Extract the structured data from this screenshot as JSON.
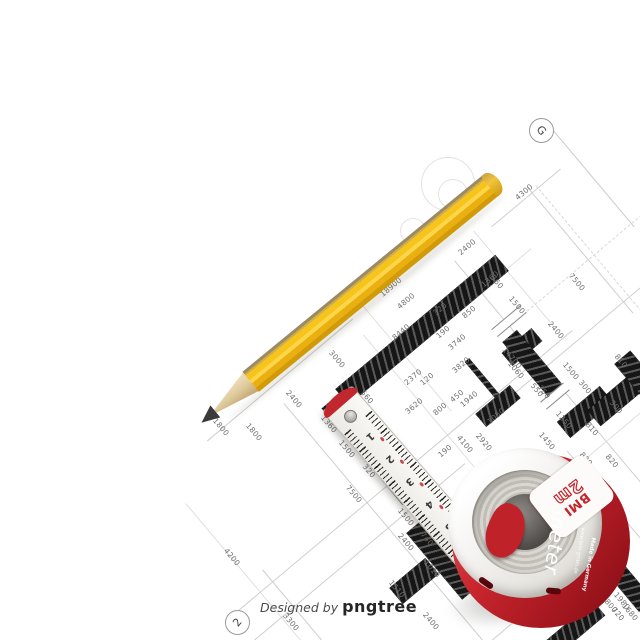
{
  "colors": {
    "paper": "#ffffff",
    "pencil_yellow": "#f6c41a",
    "tape_red": "#c1272d",
    "wall_black": "#161616",
    "dimension_text": "#6f6f6f"
  },
  "watermark": {
    "prefix": "Designed by ",
    "brand": "pngtree"
  },
  "blueprint": {
    "grid_markers": [
      {
        "label": "G"
      },
      {
        "label": "2"
      }
    ],
    "dimension_labels": [
      {
        "t": "4300",
        "x": 524,
        "y": 192,
        "r": "a"
      },
      {
        "t": "2400",
        "x": 467,
        "y": 247,
        "r": "a"
      },
      {
        "t": "1360",
        "x": 490,
        "y": 279,
        "r": "a"
      },
      {
        "t": "18900",
        "x": 391,
        "y": 287,
        "r": "a"
      },
      {
        "t": "4800",
        "x": 406,
        "y": 301,
        "r": "a"
      },
      {
        "t": "320",
        "x": 440,
        "y": 309,
        "r": "a"
      },
      {
        "t": "850",
        "x": 469,
        "y": 312,
        "r": "a"
      },
      {
        "t": "8440",
        "x": 401,
        "y": 332,
        "r": "a"
      },
      {
        "t": "190",
        "x": 443,
        "y": 332,
        "r": "a"
      },
      {
        "t": "3740",
        "x": 457,
        "y": 342,
        "r": "a"
      },
      {
        "t": "3820",
        "x": 461,
        "y": 365,
        "r": "a"
      },
      {
        "t": "2370",
        "x": 413,
        "y": 377,
        "r": "a"
      },
      {
        "t": "120",
        "x": 427,
        "y": 379,
        "r": "a"
      },
      {
        "t": "450",
        "x": 457,
        "y": 396,
        "r": "a"
      },
      {
        "t": "1940",
        "x": 469,
        "y": 399,
        "r": "a"
      },
      {
        "t": "3620",
        "x": 414,
        "y": 406,
        "r": "a"
      },
      {
        "t": "800",
        "x": 440,
        "y": 409,
        "r": "a"
      },
      {
        "t": "1050",
        "x": 496,
        "y": 416,
        "r": "a"
      },
      {
        "t": "190",
        "x": 445,
        "y": 451,
        "r": "a"
      },
      {
        "t": "360",
        "x": 497,
        "y": 282,
        "r": "b"
      },
      {
        "t": "7500",
        "x": 577,
        "y": 282,
        "r": "b"
      },
      {
        "t": "1500",
        "x": 517,
        "y": 305,
        "r": "b"
      },
      {
        "t": "2400",
        "x": 556,
        "y": 330,
        "r": "b"
      },
      {
        "t": "14700",
        "x": 512,
        "y": 358,
        "r": "b"
      },
      {
        "t": "3000",
        "x": 337,
        "y": 359,
        "r": "b"
      },
      {
        "t": "810",
        "x": 621,
        "y": 361,
        "r": "b"
      },
      {
        "t": "1060",
        "x": 516,
        "y": 370,
        "r": "b"
      },
      {
        "t": "1500",
        "x": 571,
        "y": 371,
        "r": "b"
      },
      {
        "t": "300",
        "x": 585,
        "y": 387,
        "r": "b"
      },
      {
        "t": "550",
        "x": 537,
        "y": 390,
        "r": "b"
      },
      {
        "t": "750",
        "x": 544,
        "y": 392,
        "r": "b"
      },
      {
        "t": "560",
        "x": 367,
        "y": 397,
        "r": "b"
      },
      {
        "t": "2400",
        "x": 294,
        "y": 399,
        "r": "b"
      },
      {
        "t": "300",
        "x": 616,
        "y": 407,
        "r": "b"
      },
      {
        "t": "1250",
        "x": 564,
        "y": 420,
        "r": "b"
      },
      {
        "t": "1360",
        "x": 329,
        "y": 424,
        "r": "b"
      },
      {
        "t": "1800",
        "x": 221,
        "y": 427,
        "r": "b"
      },
      {
        "t": "810",
        "x": 592,
        "y": 429,
        "r": "b"
      },
      {
        "t": "1800",
        "x": 254,
        "y": 432,
        "r": "b"
      },
      {
        "t": "1450",
        "x": 547,
        "y": 441,
        "r": "b"
      },
      {
        "t": "4100",
        "x": 465,
        "y": 444,
        "r": "b"
      },
      {
        "t": "2920",
        "x": 484,
        "y": 442,
        "r": "b"
      },
      {
        "t": "1500",
        "x": 347,
        "y": 449,
        "r": "b"
      },
      {
        "t": "820",
        "x": 586,
        "y": 459,
        "r": "b"
      },
      {
        "t": "820",
        "x": 612,
        "y": 461,
        "r": "b"
      },
      {
        "t": "320",
        "x": 369,
        "y": 471,
        "r": "b"
      },
      {
        "t": "7500",
        "x": 354,
        "y": 494,
        "r": "b"
      },
      {
        "t": "1500",
        "x": 406,
        "y": 517,
        "r": "b"
      },
      {
        "t": "740",
        "x": 427,
        "y": 539,
        "r": "b"
      },
      {
        "t": "2400",
        "x": 406,
        "y": 542,
        "r": "b"
      },
      {
        "t": "4200",
        "x": 232,
        "y": 557,
        "r": "b"
      },
      {
        "t": "1010",
        "x": 432,
        "y": 569,
        "r": "b"
      },
      {
        "t": "1900",
        "x": 602,
        "y": 569,
        "r": "b"
      },
      {
        "t": "1510",
        "x": 397,
        "y": 589,
        "r": "b"
      },
      {
        "t": "1980",
        "x": 622,
        "y": 601,
        "r": "b"
      },
      {
        "t": "800",
        "x": 611,
        "y": 606,
        "r": "b"
      },
      {
        "t": "1680",
        "x": 630,
        "y": 612,
        "r": "b"
      },
      {
        "t": "720",
        "x": 618,
        "y": 614,
        "r": "b"
      },
      {
        "t": "2400",
        "x": 431,
        "y": 621,
        "r": "b"
      },
      {
        "t": "3300",
        "x": 291,
        "y": 622,
        "r": "b"
      }
    ]
  },
  "ruler": {
    "numbers": [
      "1",
      "2",
      "3",
      "4",
      "5"
    ],
    "brand": "BMI",
    "end_number": "7"
  },
  "tape_measure": {
    "brand": "BMI",
    "brand_suffix": "meter",
    "capacity": "2m",
    "website": "www.bmi-gmbh.de",
    "origin": "Made in Germany"
  }
}
